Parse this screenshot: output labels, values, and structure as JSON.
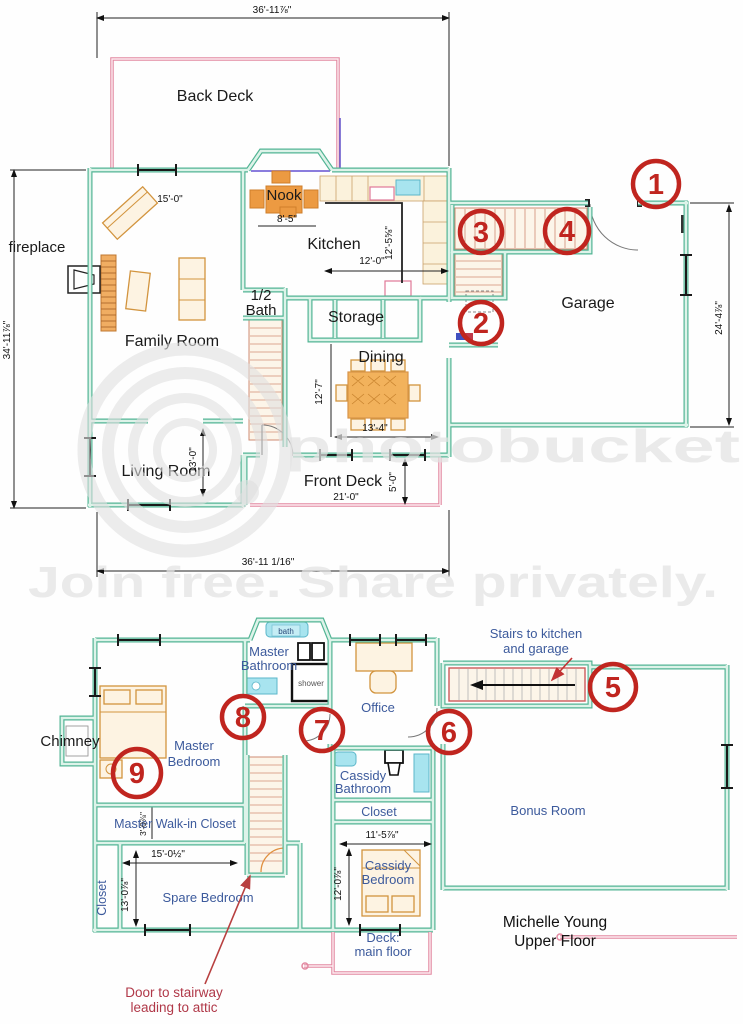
{
  "watermark": {
    "logo": "photobucket",
    "tagline": "Join free. Share privately."
  },
  "colors": {
    "wall_teal": "#52b494",
    "deck_pink": "#e288a0",
    "furniture_orange": "#ec9a42",
    "fixture_cyan": "#a8e4ef",
    "marker_red": "#c0251f",
    "upper_label_blue": "#3c5a9c",
    "annotation_red": "#b03848"
  },
  "main_floor": {
    "rooms": {
      "back_deck": "Back Deck",
      "nook": "Nook",
      "kitchen": "Kitchen",
      "fireplace": "fireplace",
      "family_room": "Family Room",
      "half_bath": [
        "1/2",
        "Bath"
      ],
      "storage": "Storage",
      "dining": "Dining",
      "garage": "Garage",
      "living_room": "Living Room",
      "front_deck": "Front Deck"
    },
    "dimensions": {
      "top_width": "36'-11⅞\"",
      "bottom_width": "36'-11 1/16\"",
      "left_height": "34'-11⅞\"",
      "garage_depth": "24'-4⅞\"",
      "family_width": "15'-0\"",
      "nook_width": "8'-5\"",
      "kitchen_width": "12'-0\"",
      "kitchen_depth": "12'-5⅝\"",
      "dining_width": "13'-4\"",
      "dining_depth": "12'-7\"",
      "living_depth": "13'-0\"",
      "front_deck_width": "21'-0\"",
      "front_deck_depth": "5'-0\""
    },
    "markers": [
      "1",
      "2",
      "3",
      "4"
    ]
  },
  "upper_floor": {
    "rooms": {
      "bath": "bath",
      "master_bathroom": [
        "Master",
        "Bathroom"
      ],
      "shower": "shower",
      "office": "Office",
      "chimney": "Chimney",
      "master_bedroom": [
        "Master",
        "Bedroom"
      ],
      "master_walkin_closet": "Master Walk-in Closet",
      "closet_left": "Closet",
      "spare_bedroom": "Spare Bedroom",
      "cassidy_bathroom": [
        "Cassidy",
        "Bathroom"
      ],
      "closet_hall": "Closet",
      "cassidy_bedroom": [
        "Cassidy",
        "Bedroom"
      ],
      "bonus_room": "Bonus Room",
      "deck": [
        "Deck:",
        "main floor"
      ]
    },
    "dimensions": {
      "walkin_depth": "3'-0⅞\"",
      "spare_width": "15'-0½\"",
      "spare_depth": "13'-0⅞\"",
      "cassidy_width": "11'-5⅞\"",
      "cassidy_depth": "12'-0⅞\""
    },
    "annotations": {
      "stairs_note": [
        "Stairs to kitchen",
        "and garage"
      ],
      "attic_note": [
        "Door to stairway",
        "leading to attic"
      ],
      "title": [
        "Michelle Young",
        "Upper Floor"
      ]
    },
    "markers": [
      "5",
      "6",
      "7",
      "8",
      "9"
    ]
  }
}
